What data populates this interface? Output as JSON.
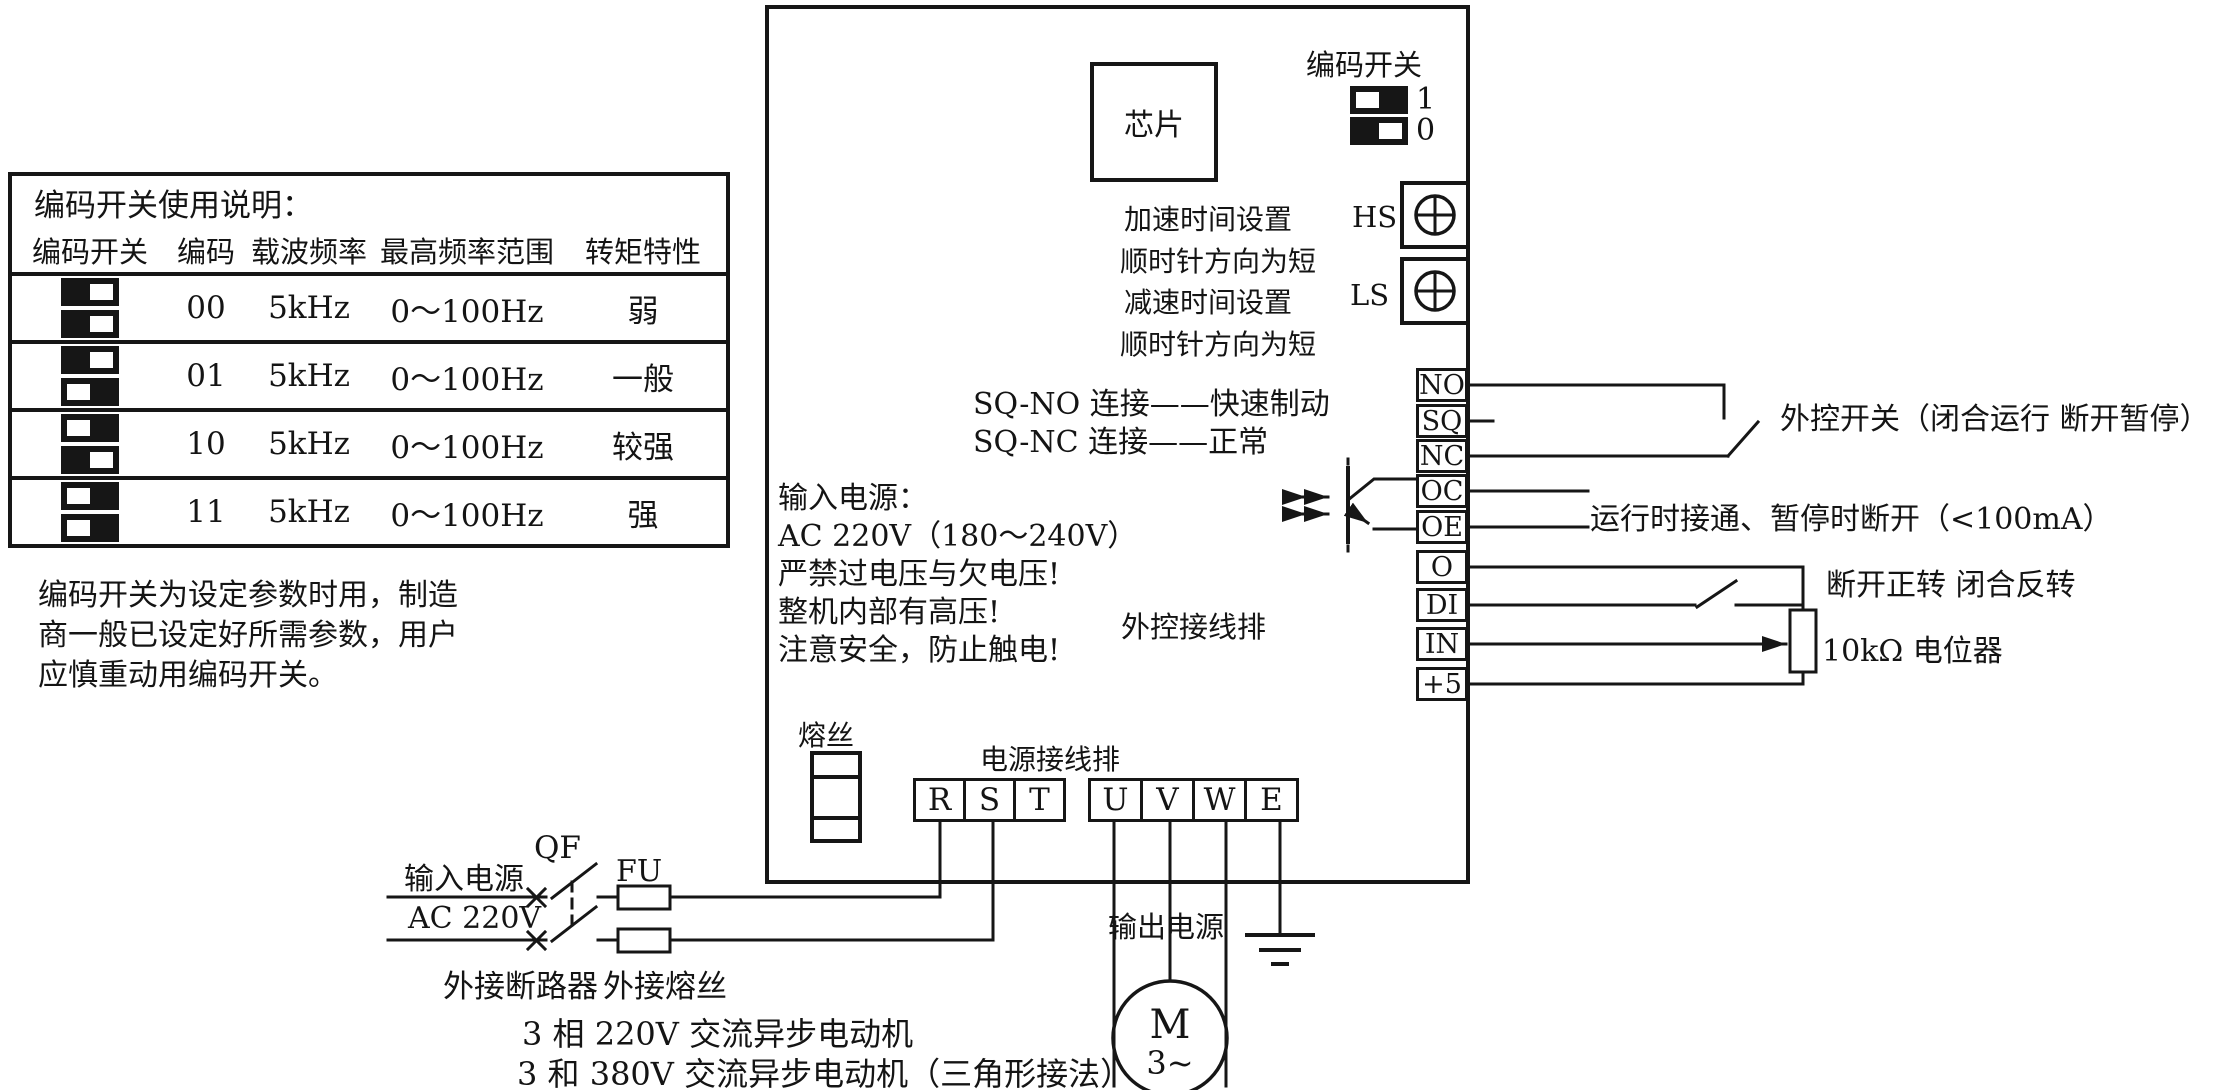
{
  "dip_table": {
    "title": "编码开关使用说明：",
    "headers": [
      "编码开关",
      "编码",
      "载波频率",
      "最高频率范围",
      "转矩特性"
    ],
    "rows": [
      {
        "sw": [
          "0",
          "0"
        ],
        "code": "00",
        "carrier": "5kHz",
        "freq_range": "0～100Hz",
        "torque": "弱"
      },
      {
        "sw": [
          "0",
          "1"
        ],
        "code": "01",
        "carrier": "5kHz",
        "freq_range": "0～100Hz",
        "torque": "一般"
      },
      {
        "sw": [
          "1",
          "0"
        ],
        "code": "10",
        "carrier": "5kHz",
        "freq_range": "0～100Hz",
        "torque": "较强"
      },
      {
        "sw": [
          "1",
          "1"
        ],
        "code": "11",
        "carrier": "5kHz",
        "freq_range": "0～100Hz",
        "torque": "强"
      }
    ],
    "note_lines": [
      "编码开关为设定参数时用，制造",
      "商一般已设定好所需参数，用户",
      "应慎重动用编码开关。"
    ]
  },
  "inverter": {
    "chip_label": "芯片",
    "dip_legend": {
      "title": "编码开关",
      "items": [
        {
          "value": "1",
          "label": "1"
        },
        {
          "value": "0",
          "label": "0"
        }
      ]
    },
    "hs_label": "HS",
    "ls_label": "LS",
    "accel_lines": [
      "加速时间设置",
      "顺时针方向为短"
    ],
    "decel_lines": [
      "减速时间设置",
      "顺时针方向为短"
    ],
    "sq_lines": [
      "SQ-NO 连接——快速制动",
      "SQ-NC 连接——正常"
    ],
    "warning_lines": [
      "输入电源：",
      "AC 220V（180～240V）",
      "严禁过电压与欠电压!",
      "整机内部有高压!",
      "注意安全，防止触电!"
    ],
    "control_strip_label": "外控接线排",
    "control_terminals": [
      "NO",
      "SQ",
      "NC",
      "OC",
      "OE",
      "O",
      "DI",
      "IN",
      "+5"
    ],
    "internal_fuse_label": "熔丝",
    "power_strip_label": "电源接线排",
    "input_terminals": [
      "R",
      "S",
      "T"
    ],
    "output_terminals": [
      "U",
      "V",
      "W",
      "E"
    ]
  },
  "right_annotations": {
    "ext_switch": "外控开关（闭合运行 断开暂停）",
    "oc_oe_note": "运行时接通、暂停时断开（<100mA）",
    "di_note": "断开正转 闭合反转",
    "pot_label": "10kΩ 电位器"
  },
  "external": {
    "input_power_label": "输入电源",
    "input_voltage_label": "AC 220V",
    "breaker_ref": "QF",
    "fuse_ref": "FU",
    "breaker_label": "外接断路器",
    "ext_fuse_label": "外接熔丝",
    "output_power_label": "输出电源",
    "motor_letter": "M",
    "motor_phase": "3~",
    "motor_notes": [
      "3 相 220V 交流异步电动机",
      "3 和 380V 交流异步电动机（三角形接法）"
    ]
  }
}
